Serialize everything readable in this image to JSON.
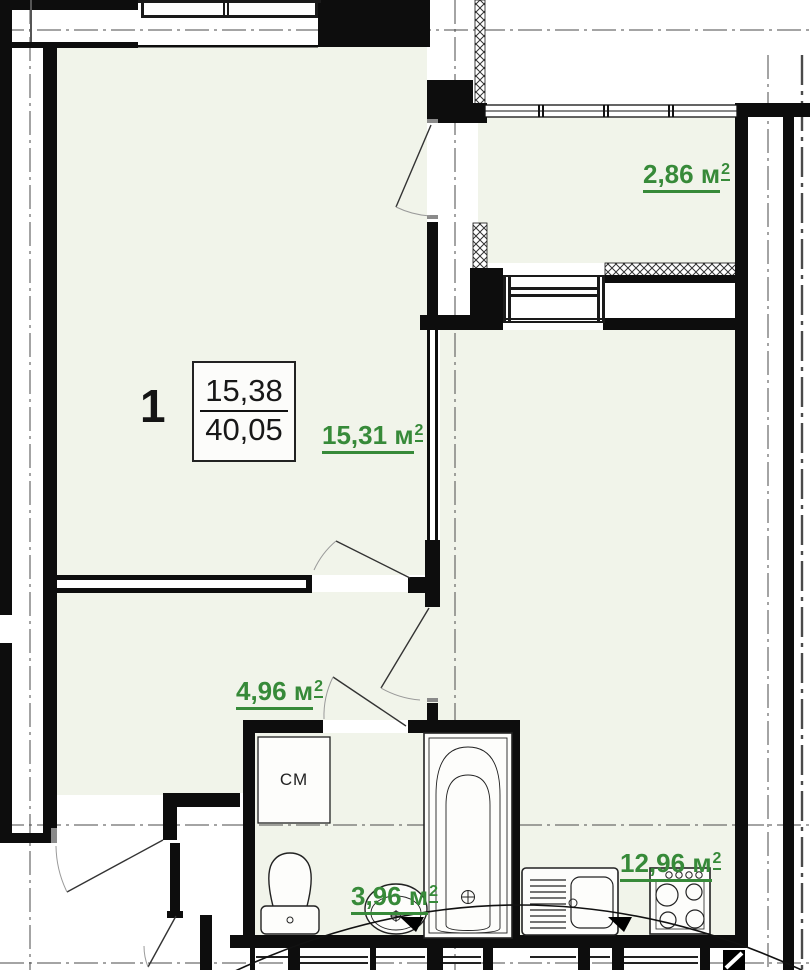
{
  "plan": {
    "apartment": {
      "number": "1",
      "living_area": "15,38",
      "total_area": "40,05"
    },
    "rooms": [
      {
        "key": "living_room",
        "area": "15,31",
        "unit": "м",
        "sup": "2"
      },
      {
        "key": "balcony",
        "area": "2,86",
        "unit": "м",
        "sup": "2"
      },
      {
        "key": "hallway",
        "area": "4,96",
        "unit": "м",
        "sup": "2"
      },
      {
        "key": "bathroom",
        "area": "3,96",
        "unit": "м",
        "sup": "2"
      },
      {
        "key": "kitchen",
        "area": "12,96",
        "unit": "м",
        "sup": "2"
      }
    ],
    "fixtures": {
      "washing_machine": "СМ"
    },
    "colors": {
      "area_label_green": "#378a39",
      "room_fill": "#f1f4ea",
      "wall_black": "#0d0d0d"
    }
  }
}
